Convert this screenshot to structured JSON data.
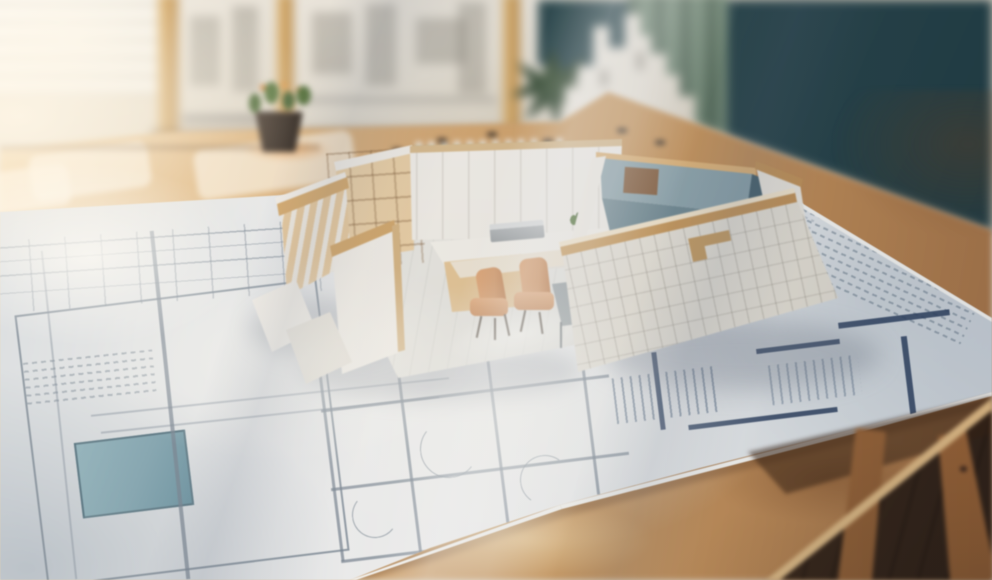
{
  "meta": {
    "title": "Sunlit architectural scale model standing on blueprint floor plans",
    "type": "photograph",
    "width_px": 992,
    "height_px": 580
  },
  "palette": {
    "wall-cream": "#ece3d1",
    "window-light": "#fdfbf4",
    "frame-wood": "#d3a766",
    "board-paper": "#eae5da",
    "teal-wall": "#2a474e",
    "curtain-green": "#6b8371",
    "castle-white": "#f1ece2",
    "pot-dark": "#39302a",
    "plant-green": "#4e6b3f",
    "accent-orange": "#d9893f",
    "table-wood": "#d9ad79",
    "green-piece": "#3e7b4b",
    "paper": "#eef1f4",
    "line-navy": "#2b4060",
    "pool-blue": "#84a8b6",
    "model-white": "#f6f3ed",
    "cap-wood": "#cfa367",
    "ply-wood": "#ecd0a6",
    "chair-tan": "#d79c6c",
    "room-teal": "#8ba4ae",
    "room-teal-dark": "#4c6673",
    "floor-dark": "#46301f",
    "leg-wood": "#b07946"
  },
  "scene": {
    "setting": "bright studio interior with sun streaks",
    "background": {
      "window": {
        "label": "bright window with blinds, top left"
      },
      "boards": {
        "label": "wood-framed presentation boards with pinned drawings"
      },
      "teal_wall": {
        "label": "dark teal wall, upper right"
      },
      "curtain": {
        "label": "green curtain fold"
      },
      "castle_model": {
        "label": "white cardboard building cut-out model"
      },
      "potted_plant": {
        "label": "succulent in dark pot with orange blooms"
      },
      "palm_plant": {
        "label": "dark green leafy plant"
      },
      "green_pieces": {
        "label": "row of green model pieces on the table",
        "count": 12
      },
      "scatter_bits": {
        "label": "small dark model bits on the table",
        "count": 6
      }
    },
    "table": {
      "label": "light oak drafting table",
      "legs": {
        "label": "trestle table legs",
        "count": 2
      },
      "floor": {
        "label": "dark wood floor, bottom right"
      }
    },
    "blueprint": {
      "label": "large architectural floor-plan sheet",
      "features": [
        "dimension lines",
        "room outlines",
        "door swing arcs",
        "navy wall segments",
        "stair hatching",
        "blue pool rectangle",
        "illegible annotation rows"
      ]
    },
    "model": {
      "label": "open-top interior scale model with wood-capped walls",
      "left_wing": {
        "label": "ribbed white sectional wing"
      },
      "shelving": {
        "label": "plywood shelving unit"
      },
      "back_wall": {
        "label": "white paneled back wall"
      },
      "counter": {
        "label": "white counter with wood cabinet"
      },
      "desk": {
        "label": "work desk with laptop and tiny plant"
      },
      "chairs": {
        "label": "tan desk chairs",
        "count": 2
      },
      "side_table": {
        "label": "small gray table"
      },
      "blue_room": {
        "label": "slate-blue room, top right"
      },
      "front_wall": {
        "label": "front wall printed with elevation drawings"
      }
    }
  }
}
